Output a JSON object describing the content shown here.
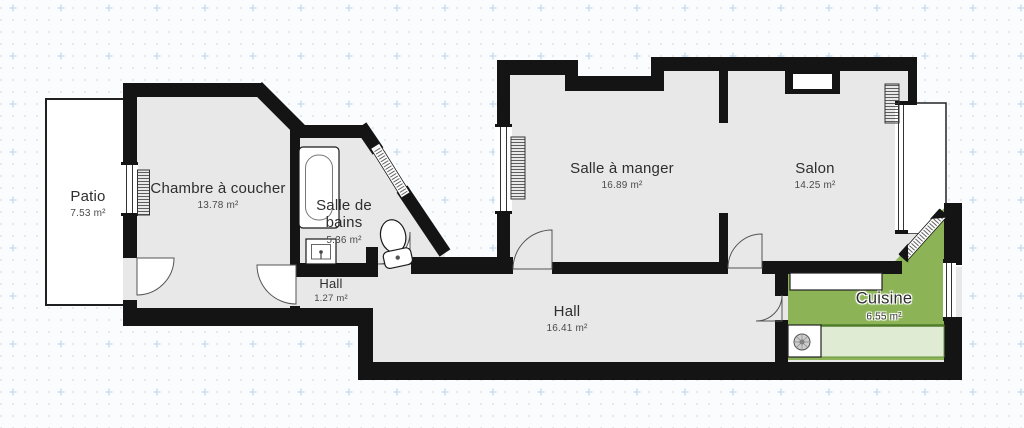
{
  "canvas": {
    "width": 1024,
    "height": 428,
    "type": "floor-plan"
  },
  "rooms": [
    {
      "id": "patio",
      "name": "Patio",
      "area": "7.53 m²"
    },
    {
      "id": "chambre",
      "name": "Chambre à coucher",
      "area": "13.78 m²"
    },
    {
      "id": "salle-de-bains",
      "name": "Salle de bains",
      "area": "5.36 m²"
    },
    {
      "id": "hall-petit",
      "name": "Hall",
      "area": "1.27 m²"
    },
    {
      "id": "salle-a-manger",
      "name": "Salle à manger",
      "area": "16.89 m²"
    },
    {
      "id": "salon",
      "name": "Salon",
      "area": "14.25 m²"
    },
    {
      "id": "hall-principal",
      "name": "Hall",
      "area": "16.41 m²"
    },
    {
      "id": "cuisine",
      "name": "Cuisine",
      "area": "6.55 m²"
    }
  ],
  "fixtures": [
    "bathtub",
    "sink",
    "toilet",
    "radiator",
    "stove-burner",
    "kitchen-counter",
    "window",
    "door",
    "bay-window"
  ],
  "colors": {
    "wall": "#141414",
    "floor": "#e8e8e8",
    "kitchen_floor": "#8cb456",
    "counter_light": "#dfecd3",
    "counter_edge": "#5d8c33",
    "background": "#fbfcfe",
    "grid_dot": "#d7dce1",
    "grid_plus": "#b9d4e9",
    "label_text": "#2e2e2e"
  }
}
